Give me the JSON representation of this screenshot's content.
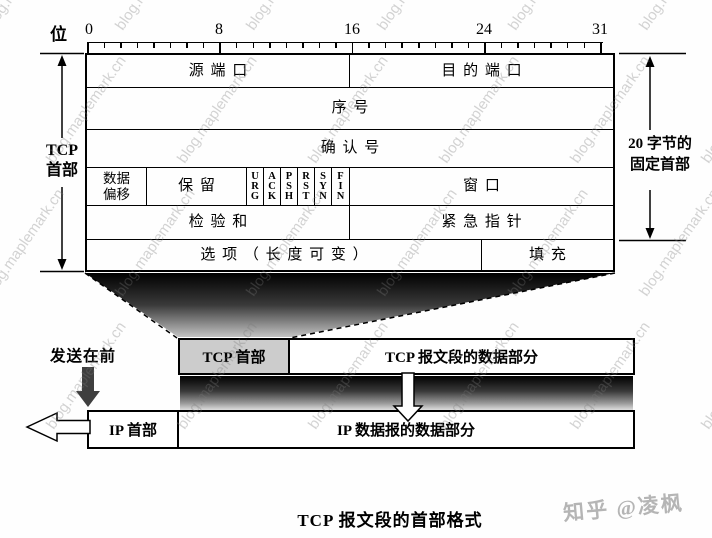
{
  "ruler": {
    "unit_label": "位",
    "labels": [
      "0",
      "8",
      "16",
      "24",
      "31"
    ]
  },
  "left_bracket": {
    "label": "TCP\n首部"
  },
  "right_bracket": {
    "label": "20 字节的\n固定首部"
  },
  "header_fields": {
    "source_port": "源端口",
    "dest_port": "目的端口",
    "seq_no": "序号",
    "ack_no": "确认号",
    "data_offset": "数据\n偏移",
    "reserved": "保留",
    "flags": [
      "U\nR\nG",
      "A\nC\nK",
      "P\nS\nH",
      "R\nS\nT",
      "S\nY\nN",
      "F\nI\nN"
    ],
    "window": "窗口",
    "checksum": "检验和",
    "urgent_pointer": "紧急指针",
    "options": "选项（长度可变）",
    "padding": "填充"
  },
  "segment_view": {
    "sent_first_label": "发送在前",
    "tcp_header": "TCP 首部",
    "tcp_data": "TCP 报文段的数据部分",
    "ip_header": "IP 首部",
    "ip_data": "IP 数据报的数据部分"
  },
  "caption": "TCP 报文段的首部格式",
  "watermarks": {
    "tile_text": "blog.maplemark.cn",
    "credit": "知乎 @凌枫"
  },
  "colors": {
    "tcp_header_fill": "#cccccc",
    "gray_arrow": "#3f3f3f",
    "line_black": "#000000"
  }
}
